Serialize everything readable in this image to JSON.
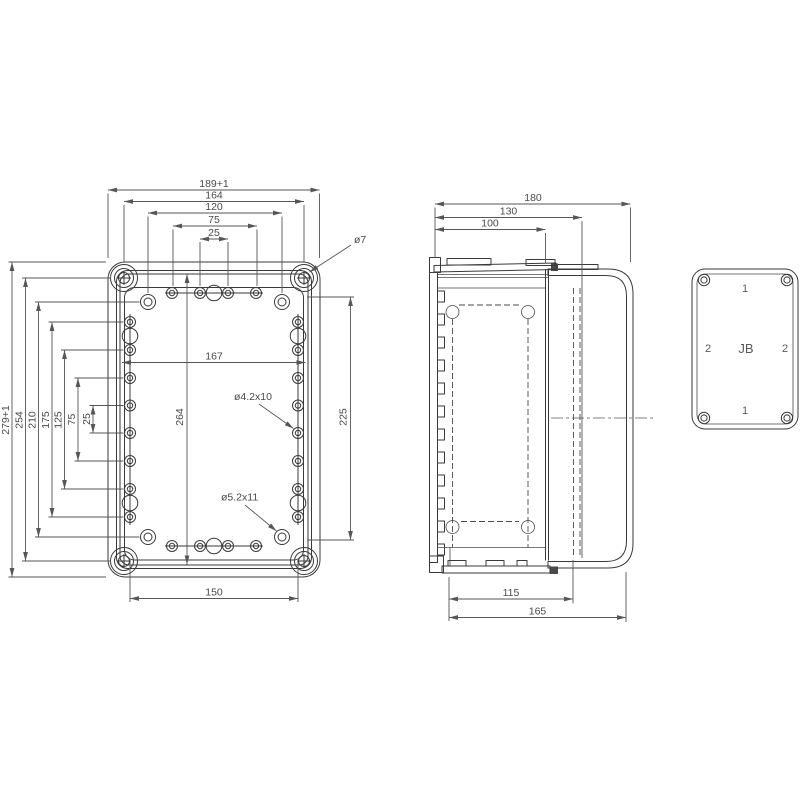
{
  "drawing_type": "enclosure-dimension-drawing",
  "colors": {
    "background": "#ffffff",
    "line": "#3a3a3a",
    "dimension_line": "#565656",
    "text": "#4a4a4a"
  },
  "front_view": {
    "dims_top": [
      "189+1",
      "164",
      "120",
      "75",
      "25"
    ],
    "dims_left": [
      "279+1",
      "254",
      "210",
      "175",
      "125",
      "75",
      "25"
    ],
    "dim_inner_width": "167",
    "dim_inner_height": "264",
    "dim_right_height": "225",
    "dim_bottom": "150",
    "note_corner_hole": "ø7",
    "note_side_hole": "ø4.2x10",
    "note_bottom_hole": "ø5.2x11"
  },
  "side_view": {
    "dims_top": [
      "180",
      "130",
      "100"
    ],
    "dims_bottom": [
      "115",
      "165"
    ]
  },
  "cover_view": {
    "top": "1",
    "left": "2",
    "center": "JB",
    "right": "2",
    "bottom": "1"
  }
}
